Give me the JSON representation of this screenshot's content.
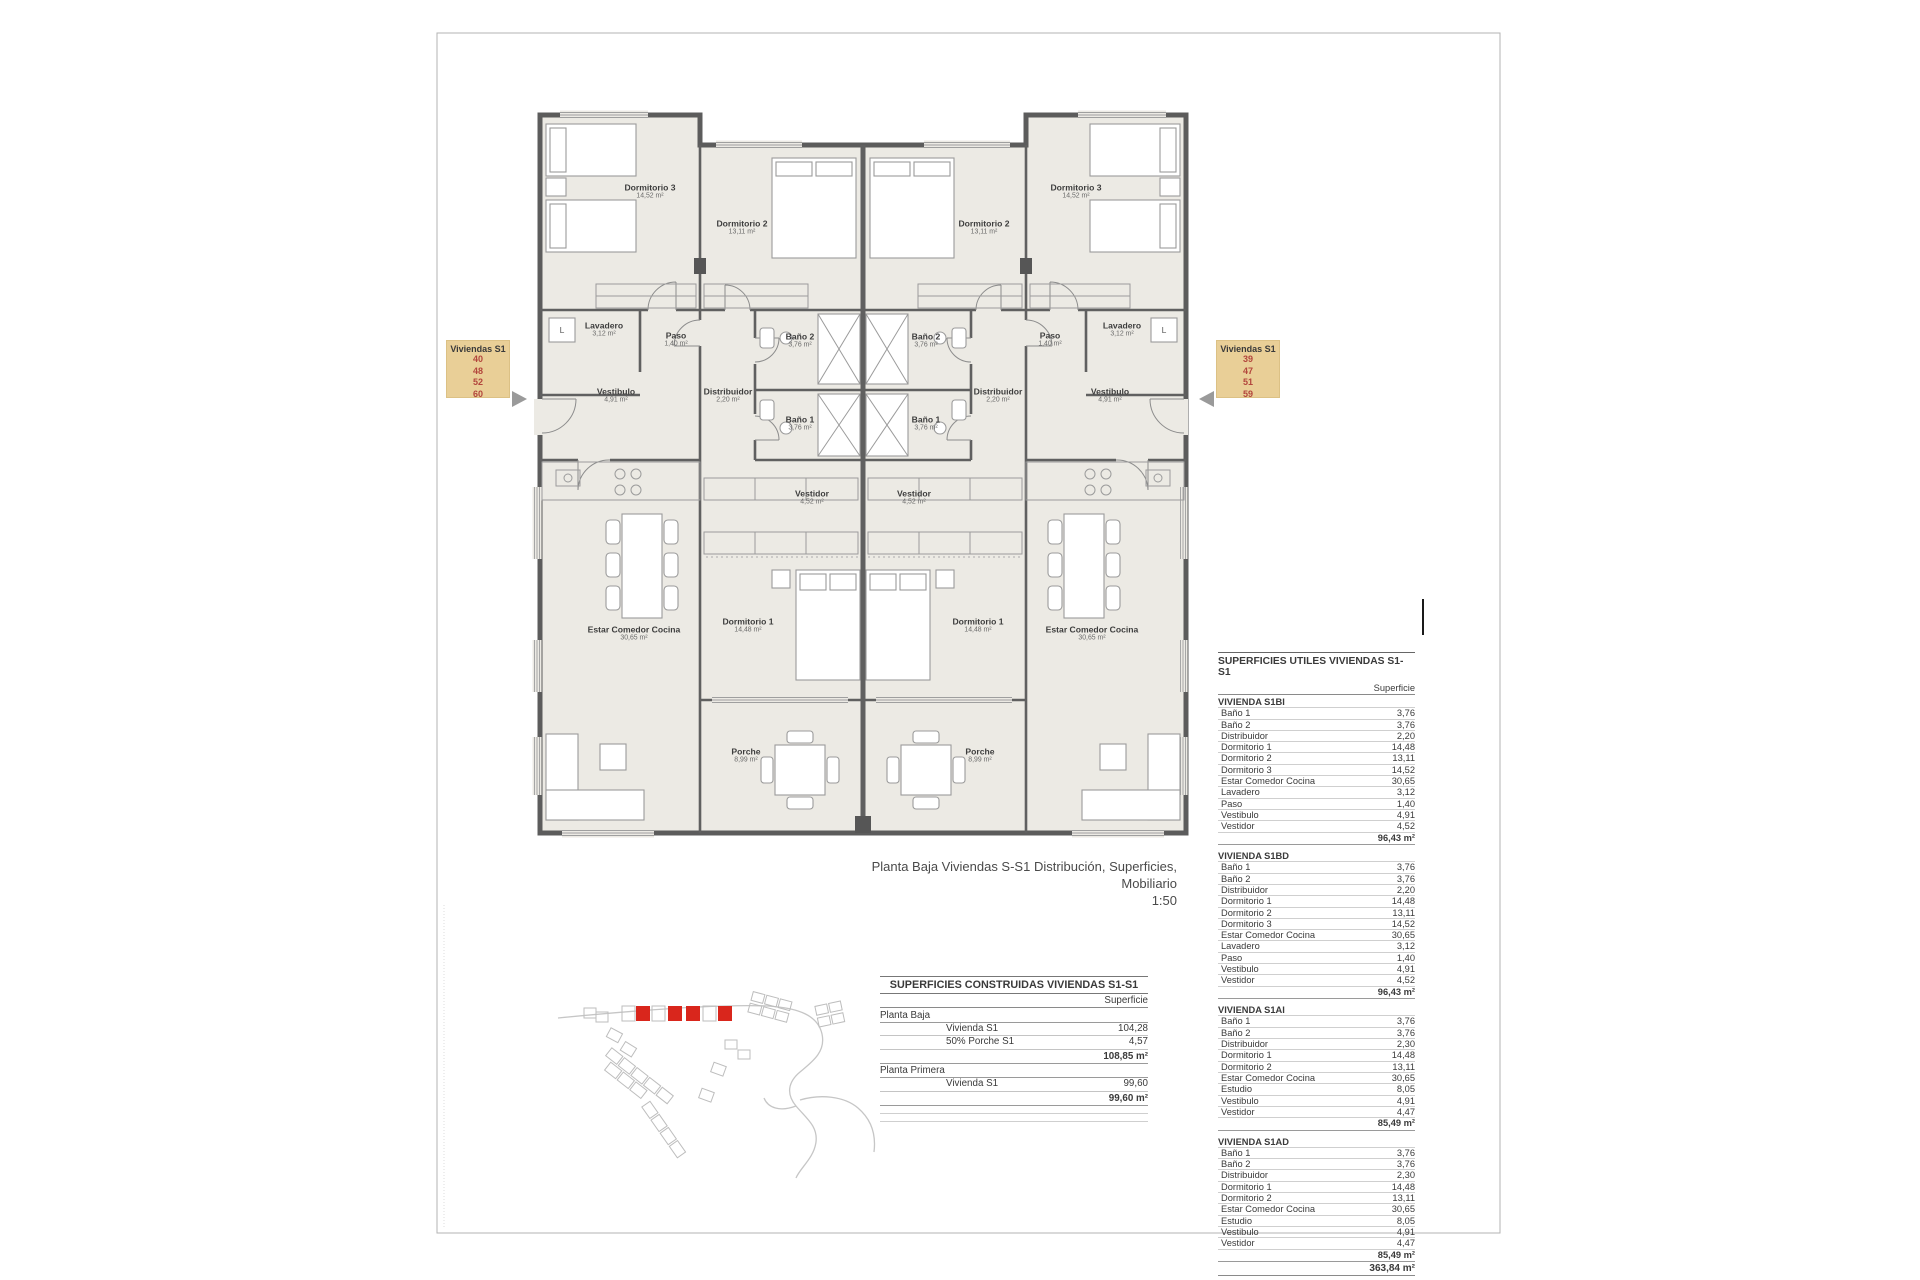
{
  "colors": {
    "highlight": "#d9261c",
    "annotation_bg": "#e9cf97",
    "annotation_number": "#b2453c"
  },
  "annotations": {
    "left": {
      "title": "Viviendas S1",
      "units": [
        "40",
        "48",
        "52",
        "60"
      ]
    },
    "right": {
      "title": "Viviendas S1",
      "units": [
        "39",
        "47",
        "51",
        "59"
      ]
    }
  },
  "caption": {
    "line1": "Planta Baja Viviendas S-S1 Distribución, Superficies, Mobiliario",
    "line2": "1:50"
  },
  "plan": {
    "lavadero_tag": "L",
    "rooms": [
      {
        "name": "Dormitorio 3",
        "area": "14,52 m²"
      },
      {
        "name": "Dormitorio 2",
        "area": "13,11 m²"
      },
      {
        "name": "Dormitorio 2",
        "area": "13,11 m²"
      },
      {
        "name": "Dormitorio 3",
        "area": "14,52 m²"
      },
      {
        "name": "Lavadero",
        "area": "3,12 m²"
      },
      {
        "name": "Paso",
        "area": "1,40 m²"
      },
      {
        "name": "Baño 2",
        "area": "3,76 m²"
      },
      {
        "name": "Baño 2",
        "area": "3,76 m²"
      },
      {
        "name": "Paso",
        "area": "1,40 m²"
      },
      {
        "name": "Lavadero",
        "area": "3,12 m²"
      },
      {
        "name": "Vestibulo",
        "area": "4,91 m²"
      },
      {
        "name": "Distribuidor",
        "area": "2,20 m²"
      },
      {
        "name": "Distribuidor",
        "area": "2,20 m²"
      },
      {
        "name": "Vestibulo",
        "area": "4,91 m²"
      },
      {
        "name": "Baño 1",
        "area": "3,76 m²"
      },
      {
        "name": "Baño 1",
        "area": "3,76 m²"
      },
      {
        "name": "Vestidor",
        "area": "4,52 m²"
      },
      {
        "name": "Vestidor",
        "area": "4,52 m²"
      },
      {
        "name": "Estar Comedor Cocina",
        "area": "30,65 m²"
      },
      {
        "name": "Dormitorio 1",
        "area": "14,48 m²"
      },
      {
        "name": "Dormitorio 1",
        "area": "14,48 m²"
      },
      {
        "name": "Estar Comedor Cocina",
        "area": "30,65 m²"
      },
      {
        "name": "Porche",
        "area": "8,99 m²"
      },
      {
        "name": "Porche",
        "area": "8,99 m²"
      }
    ]
  },
  "tables": {
    "construidas": {
      "title": "SUPERFICIES CONSTRUIDAS VIVIENDAS S1-S1",
      "col_header": "Superficie",
      "groups": [
        {
          "name": "Planta Baja",
          "rows": [
            [
              "Vivienda S1",
              "104,28"
            ],
            [
              "50% Porche S1",
              "4,57"
            ]
          ],
          "total": "108,85 m²"
        },
        {
          "name": "Planta Primera",
          "rows": [
            [
              "Vivienda S1",
              "99,60"
            ]
          ],
          "total": "99,60 m²"
        }
      ]
    },
    "utiles": {
      "title": "SUPERFICIES UTILES VIVIENDAS S1-S1",
      "col_header": "Superficie",
      "sections": [
        {
          "name": "VIVIENDA S1BI",
          "rows": [
            [
              "Baño 1",
              "3,76"
            ],
            [
              "Baño 2",
              "3,76"
            ],
            [
              "Distribuidor",
              "2,20"
            ],
            [
              "Dormitorio 1",
              "14,48"
            ],
            [
              "Dormitorio 2",
              "13,11"
            ],
            [
              "Dormitorio 3",
              "14,52"
            ],
            [
              "Estar Comedor Cocina",
              "30,65"
            ],
            [
              "Lavadero",
              "3,12"
            ],
            [
              "Paso",
              "1,40"
            ],
            [
              "Vestibulo",
              "4,91"
            ],
            [
              "Vestidor",
              "4,52"
            ]
          ],
          "total": "96,43 m²"
        },
        {
          "name": "VIVIENDA S1BD",
          "rows": [
            [
              "Baño 1",
              "3,76"
            ],
            [
              "Baño 2",
              "3,76"
            ],
            [
              "Distribuidor",
              "2,20"
            ],
            [
              "Dormitorio 1",
              "14,48"
            ],
            [
              "Dormitorio 2",
              "13,11"
            ],
            [
              "Dormitorio 3",
              "14,52"
            ],
            [
              "Estar Comedor Cocina",
              "30,65"
            ],
            [
              "Lavadero",
              "3,12"
            ],
            [
              "Paso",
              "1,40"
            ],
            [
              "Vestibulo",
              "4,91"
            ],
            [
              "Vestidor",
              "4,52"
            ]
          ],
          "total": "96,43 m²"
        },
        {
          "name": "VIVIENDA S1AI",
          "rows": [
            [
              "Baño 1",
              "3,76"
            ],
            [
              "Baño 2",
              "3,76"
            ],
            [
              "Distribuidor",
              "2,30"
            ],
            [
              "Dormitorio 1",
              "14,48"
            ],
            [
              "Dormitorio 2",
              "13,11"
            ],
            [
              "Estar Comedor Cocina",
              "30,65"
            ],
            [
              "Estudio",
              "8,05"
            ],
            [
              "Vestibulo",
              "4,91"
            ],
            [
              "Vestidor",
              "4,47"
            ]
          ],
          "total": "85,49 m²"
        },
        {
          "name": "VIVIENDA S1AD",
          "rows": [
            [
              "Baño 1",
              "3,76"
            ],
            [
              "Baño 2",
              "3,76"
            ],
            [
              "Distribuidor",
              "2,30"
            ],
            [
              "Dormitorio 1",
              "14,48"
            ],
            [
              "Dormitorio 2",
              "13,11"
            ],
            [
              "Estar Comedor Cocina",
              "30,65"
            ],
            [
              "Estudio",
              "8,05"
            ],
            [
              "Vestibulo",
              "4,91"
            ],
            [
              "Vestidor",
              "4,47"
            ]
          ],
          "total": "85,49 m²"
        }
      ],
      "grand_total": "363,84 m²"
    }
  }
}
